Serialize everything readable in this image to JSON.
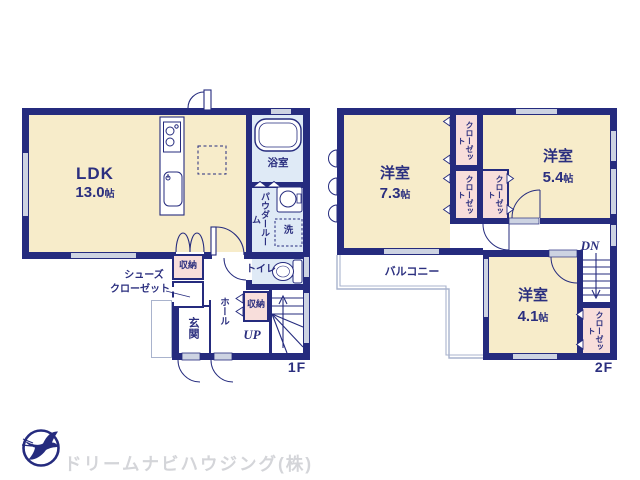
{
  "palette": {
    "wall_navy": "#252b7e",
    "room_cream": "#f7ecca",
    "wet_blue": "#dfeaf6",
    "closet_pink": "#f8dedb",
    "window_gray": "#cdd3e2",
    "text_navy": "#2b2f7f",
    "balcony_line": "#a9b3cd",
    "logo_text_gray": "#d4d5d9"
  },
  "floor1": {
    "floor_label": "1F",
    "ldk": {
      "name": "LDK",
      "size_value": "13.0",
      "size_unit": "帖"
    },
    "bath_label": "浴室",
    "powder_label": "パウダールーム",
    "laundry_label": "洗",
    "toilet_label": "トイレ",
    "storage_label_a": "収納",
    "storage_label_b": "収納",
    "shoes_line1": "シューズ",
    "shoes_line2": "クローゼット",
    "entrance_label": "玄関",
    "hall_label": "ホール",
    "up_label": "UP"
  },
  "floor2": {
    "floor_label": "2F",
    "room_west": {
      "name": "洋室",
      "size_value": "7.3",
      "size_unit": "帖"
    },
    "room_east": {
      "name": "洋室",
      "size_value": "5.4",
      "size_unit": "帖"
    },
    "room_south": {
      "name": "洋室",
      "size_value": "4.1",
      "size_unit": "帖"
    },
    "closet_label_a": "クローゼット",
    "closet_label_b": "クローゼット",
    "closet_label_c": "クローゼット",
    "closet_label_d": "クローゼット",
    "balcony_label": "バルコニー",
    "dn_label": "DN"
  },
  "footer": {
    "company_name": "ドリームナビハウジング(株)"
  }
}
